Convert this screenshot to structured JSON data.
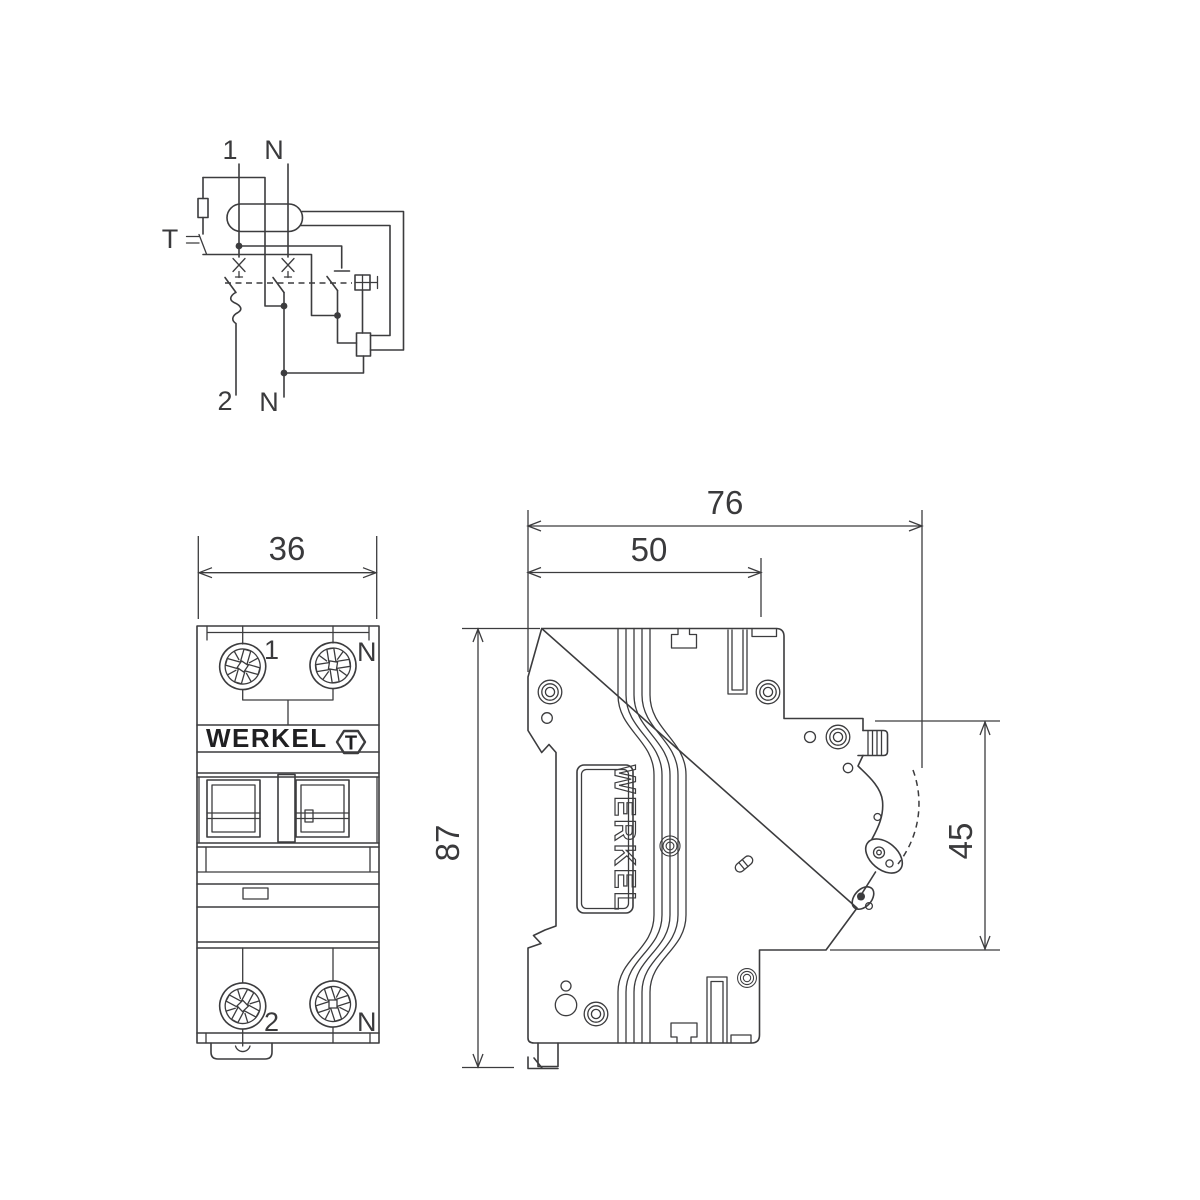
{
  "colors": {
    "line": "#3c3c3e",
    "text": "#3a3a3c",
    "background": "#ffffff"
  },
  "schematic": {
    "label_line_in": "1",
    "label_neutral_in": "N",
    "label_test_button": "T",
    "label_line_out": "2",
    "label_neutral_out": "N"
  },
  "front_view": {
    "dim_width": "36",
    "brand": "WERKEL",
    "test_button": "T",
    "terminal_top_left": "1",
    "terminal_top_right": "N",
    "terminal_bottom_left": "2",
    "terminal_bottom_right": "N"
  },
  "side_view": {
    "dim_overall_depth": "76",
    "dim_body_depth": "50",
    "dim_height": "87",
    "dim_front_height": "45",
    "brand": "WERKEL"
  }
}
